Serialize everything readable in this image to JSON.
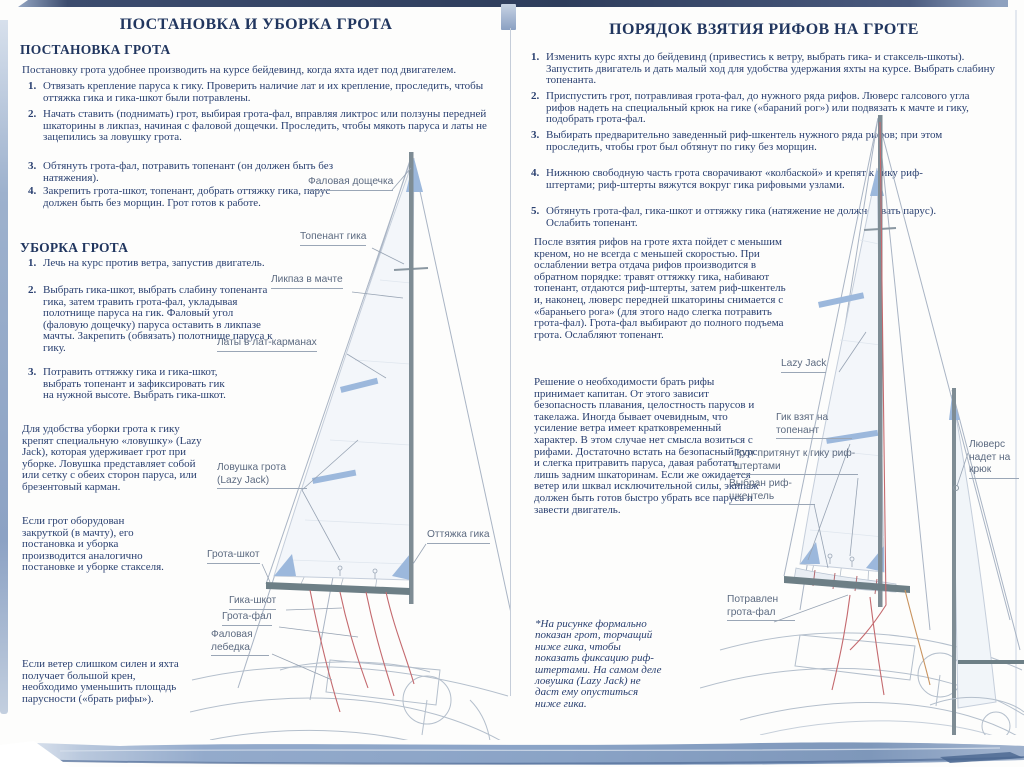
{
  "left_page": {
    "title": "ПОСТАНОВКА И УБОРКА ГРОТА",
    "setting": {
      "heading": "ПОСТАНОВКА ГРОТА",
      "intro": "Постановку грота удобнее производить на курсе бейдевинд, когда яхта идет под двигателем.",
      "items": [
        {
          "num": "1.",
          "text": "Отвязать крепление паруса к гику. Проверить наличие лат и их крепление, проследить, чтобы оттяжка гика и гика-шкот были потравлены."
        },
        {
          "num": "2.",
          "text": "Начать ставить (поднимать) грот, выбирая грота-фал, вправляя ликтрос или ползуны передней шкаторины в ликпаз, начиная с фаловой дощечки. Проследить, чтобы мякоть паруса и латы не зацепились за ловушку грота."
        },
        {
          "num": "3.",
          "text": "Обтянуть грота-фал, потравить топенант (он должен быть без натяжения)."
        },
        {
          "num": "4.",
          "text": "Закрепить грота-шкот, топенант, добрать оттяжку гика, парус должен быть без морщин. Грот готов к работе."
        }
      ]
    },
    "stowing": {
      "heading": "УБОРКА ГРОТА",
      "items": [
        {
          "num": "1.",
          "text": "Лечь на курс против ветра, запустив двигатель."
        },
        {
          "num": "2.",
          "text": "Выбрать гика-шкот, выбрать слабину топенанта гика, затем травить грота-фал, укладывая полотнище паруса на гик. Фаловый угол (фаловую дощечку) паруса оставить в ликпазе мачты. Закрепить (обвязать) полотнище паруса к гику."
        },
        {
          "num": "3.",
          "text": "Потравить оттяжку гика и гика-шкот, выбрать топенант и зафиксировать гик на нужной высоте. Выбрать гика-шкот."
        }
      ]
    },
    "paragraphs": [
      "Для удобства уборки грота к гику крепят специальную «ловушку» (Lazy Jack), которая удерживает грот при уборке. Ловушка представляет собой или сетку с обеих сторон паруса, или брезентовый карман.",
      "Если грот оборудован закруткой (в мачту), его постановка и уборка производится аналогично постановке и уборке стакселя.",
      "Если ветер слишком силен и яхта получает большой крен, необходимо уменьшить площадь парусности («брать рифы»)."
    ],
    "diagram_labels": [
      "Фаловая дощечка",
      "Топенант гика",
      "Ликпаз в мачте",
      "Латы в лат-карманах",
      "Ловушка грота (Lazy Jack)",
      "Оттяжка гика",
      "Грота-шкот",
      "Гика-шкот",
      "Грота-фал",
      "Фаловая лебедка"
    ]
  },
  "right_page": {
    "title": "ПОРЯДОК ВЗЯТИЯ РИФОВ НА ГРОТЕ",
    "items": [
      {
        "num": "1.",
        "text": "Изменить курс яхты до бейдевинд (привестись к ветру, выбрать гика- и стаксель-шкоты). Запустить двигатель и дать малый ход для удобства удержания яхты на курсе. Выбрать слабину топенанта."
      },
      {
        "num": "2.",
        "text": "Приспустить грот, потравливая грота-фал, до нужного ряда рифов. Люверс галсового угла рифов надеть на специальный крюк на гике («бараний рог») или подвязать к мачте и гику, подобрать грота-фал."
      },
      {
        "num": "3.",
        "text": "Выбирать предварительно заведенный риф-шкентель нужного ряда рифов; при этом проследить, чтобы грот был обтянут по гику без морщин."
      },
      {
        "num": "4.",
        "text": "Нижнюю свободную часть грота сворачивают «колбаской» и крепят к гику риф-штертами; риф-штерты вяжутся вокруг гика рифовыми узлами."
      },
      {
        "num": "5.",
        "text": "Обтянуть грота-фал, гика-шкот и оттяжку гика (натяжение не должно рвать парус). Ослабить топенант."
      }
    ],
    "paragraphs": [
      "После взятия рифов на гроте яхта пойдет с меньшим креном, но не всегда с меньшей скоростью. При ослаблении ветра отдача рифов производится в обратном порядке: травят оттяжку гика, набивают топенант, отдаются риф-штерты, затем риф-шкентель и, наконец, люверс передней шкаторины снимается с «бараньего рога» (для этого надо слегка потравить грота-фал). Грота-фал выбирают до полного подъема грота. Ослабляют топенант.",
      "Решение о необходимости брать рифы принимает капитан. От этого зависит безопасность плавания, целостность парусов и такелажа. Иногда бывает очевидным, что усиление ветра имеет кратковременный характер. В этом случае нет смысла возиться с рифами. Достаточно встать на безопасный курс и слегка притравить паруса, давая работать лишь задним шкаторинам. Если же ожидается ветер или шквал исключительной силы, экипаж должен быть готов быстро убрать все паруса и завести двигатель."
    ],
    "footnote": "*На рисунке формально показан грот, торчащий ниже гика, чтобы показать фиксацию риф-штертами. На самом деле ловушка (Lazy Jack) не даст ему опуститься ниже гика.",
    "diagram_labels": [
      "Lazy Jack",
      "Гик взят на топенант",
      "Грот притянут к гику риф-штертами",
      "Выбран риф-шкентель",
      "Люверс надет на крюк",
      "Потравлен грота-фал"
    ]
  },
  "colors": {
    "text": "#2a4070",
    "heading": "#21365f",
    "label": "#5c6a80",
    "sail_patch_blue": "#9cb8dc",
    "wave_blue": "#8aa3c6",
    "topbar_navy": "#2e3d5c",
    "rope_red": "#c4696e"
  }
}
